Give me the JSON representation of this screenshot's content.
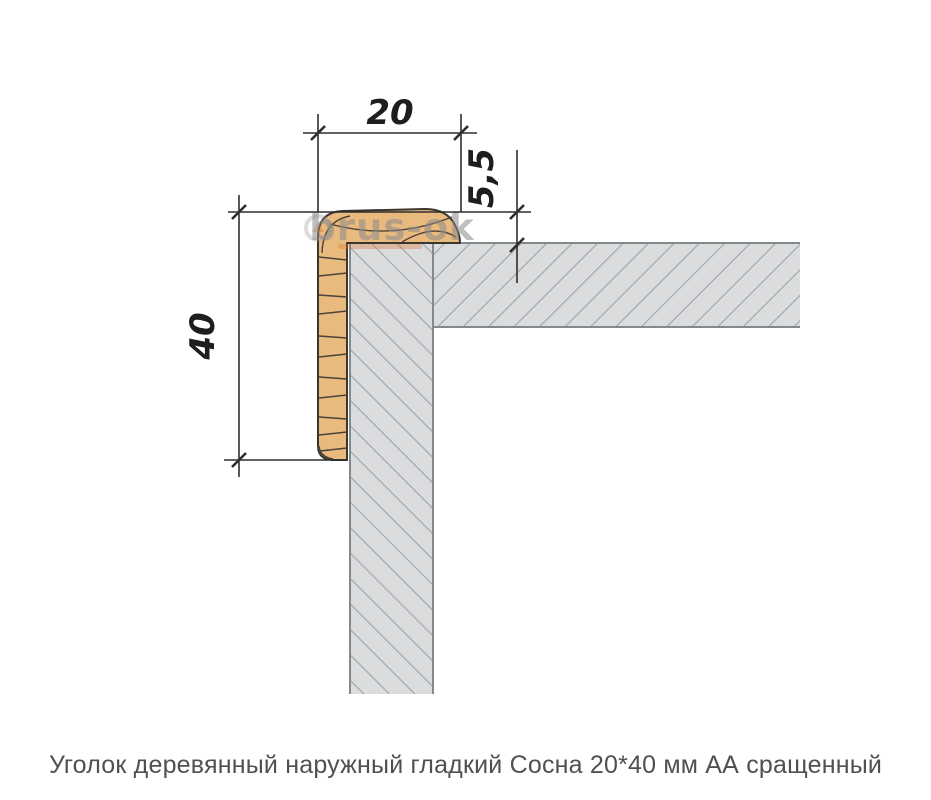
{
  "page": {
    "background": "#ffffff"
  },
  "drawing": {
    "caption": "Уголок деревянный наружный гладкий Сосна 20*40 мм АА сращенный",
    "watermark": {
      "brand": "brus-ok"
    },
    "dims": {
      "width": "20",
      "height": "40",
      "thickness": "5,5"
    },
    "colors": {
      "wood_fill": "#e9ba7e",
      "wood_outline": "#3c352e",
      "wood_grain": "#4a4238",
      "wall_fill": "#dbdcdd",
      "wall_hatch": "#9fa3a6",
      "wall_border": "#84898b",
      "dim_lines": "#2e2e2e",
      "caption_text": "#4f5052",
      "watermark_gray": "#8c8c8c",
      "watermark_orange": "#d6762c"
    }
  }
}
